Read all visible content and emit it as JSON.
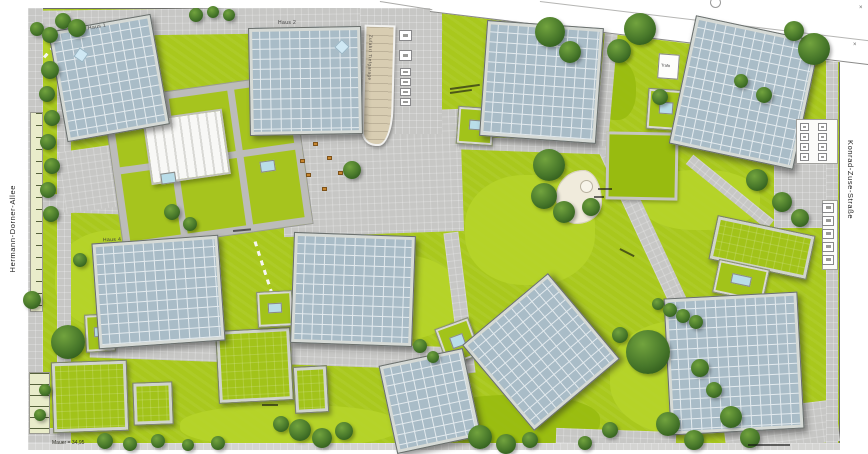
{
  "streets": {
    "left_label": "Hermann-Dorner-Allee",
    "right_label": "Konrad-Zuse-Straße"
  },
  "labels": {
    "haus1": "Haus 1",
    "haus2": "Haus 2",
    "haus4": "Haus 4",
    "ramp": "Zufahrt Tiefgarage",
    "trafo": "Trafo",
    "elevation_note": "Mauer = 34,95",
    "surveyor_mark": "×"
  },
  "colors": {
    "lawn": "#a9c81d",
    "lawn_light": "#b6d42a",
    "lawn_dark": "#98bb10",
    "pavement": "#c7c7c5",
    "pavement_light": "#d4d4d2",
    "solar_roof": "#a9bcc7",
    "solar_grid": "#e3eaee",
    "roof_frame": "#d6dad6",
    "pool": "#b9dde9",
    "ramp": "#d8cdb2",
    "bench": "#c8862f"
  },
  "plan": {
    "paths": [
      {
        "x": 28,
        "y": 8,
        "w": 414,
        "h": 26,
        "rot": -0.8
      },
      {
        "x": 440,
        "y": 15,
        "w": 402,
        "h": 13,
        "rot": 6.9
      },
      {
        "x": 28,
        "y": 8,
        "w": 15,
        "h": 438,
        "rot": 0
      },
      {
        "x": 57,
        "y": 12,
        "w": 14,
        "h": 434,
        "rot": 0
      },
      {
        "x": 282,
        "y": 112,
        "w": 180,
        "h": 122,
        "rot": -2
      },
      {
        "x": 360,
        "y": 8,
        "w": 82,
        "h": 126,
        "rot": 0
      },
      {
        "x": 668,
        "y": 132,
        "w": 18,
        "h": 334,
        "rot": -25
      },
      {
        "x": 90,
        "y": 341,
        "w": 372,
        "h": 23,
        "rot": 2
      },
      {
        "x": 774,
        "y": 150,
        "w": 64,
        "h": 78,
        "rot": 0
      },
      {
        "x": 724,
        "y": 406,
        "w": 114,
        "h": 42,
        "rot": -7
      },
      {
        "x": 28,
        "y": 195,
        "w": 104,
        "h": 18,
        "rot": 2
      },
      {
        "x": 458,
        "y": 139,
        "w": 152,
        "h": 13,
        "rot": 2
      },
      {
        "x": 678,
        "y": 186,
        "w": 104,
        "h": 12,
        "rot": 39
      },
      {
        "x": 600,
        "y": 28,
        "w": 13,
        "h": 118,
        "rot": 5
      },
      {
        "x": 62,
        "y": 148,
        "w": 58,
        "h": 62,
        "rot": -8
      },
      {
        "x": 28,
        "y": 428,
        "w": 32,
        "h": 19,
        "rot": 0
      },
      {
        "x": 452,
        "y": 232,
        "w": 15,
        "h": 142,
        "rot": -7
      },
      {
        "x": 826,
        "y": 56,
        "w": 12,
        "h": 390,
        "rot": 0
      },
      {
        "x": 556,
        "y": 430,
        "w": 120,
        "h": 16,
        "rot": 2
      },
      {
        "x": 28,
        "y": 443,
        "w": 812,
        "h": 7,
        "rot": 0,
        "c": "pavement_light"
      }
    ],
    "lawn_patches": [
      {
        "x": 55,
        "y": 230,
        "w": 130,
        "h": 100
      },
      {
        "x": 465,
        "y": 175,
        "w": 130,
        "h": 110
      },
      {
        "x": 610,
        "y": 320,
        "w": 160,
        "h": 115
      },
      {
        "x": 180,
        "y": 405,
        "w": 220,
        "h": 42
      },
      {
        "x": 330,
        "y": 255,
        "w": 130,
        "h": 85
      },
      {
        "x": 30,
        "y": 24,
        "w": 46,
        "h": 42
      },
      {
        "x": 640,
        "y": 170,
        "w": 120,
        "h": 60
      },
      {
        "x": 430,
        "y": 395,
        "w": 170,
        "h": 52,
        "d": 1
      },
      {
        "x": 596,
        "y": 60,
        "w": 40,
        "h": 60,
        "d": 1
      },
      {
        "x": 240,
        "y": 140,
        "w": 70,
        "h": 22,
        "d": 1
      }
    ],
    "lawn_squares": [
      {
        "x": 606,
        "y": 132,
        "w": 72,
        "h": 68,
        "rot": 1
      }
    ],
    "green_roofs": [
      {
        "x": 52,
        "y": 361,
        "w": 76,
        "h": 71,
        "rot": -2
      },
      {
        "x": 133,
        "y": 382,
        "w": 40,
        "h": 43,
        "rot": -2
      },
      {
        "x": 217,
        "y": 329,
        "w": 75,
        "h": 73,
        "rot": -3
      },
      {
        "x": 294,
        "y": 366,
        "w": 34,
        "h": 47,
        "rot": -3
      },
      {
        "x": 712,
        "y": 225,
        "w": 100,
        "h": 45,
        "rot": 12
      }
    ],
    "pool_courts": [
      {
        "x": 85,
        "y": 314,
        "w": 30,
        "h": 38,
        "rot": -3
      },
      {
        "x": 257,
        "y": 291,
        "w": 36,
        "h": 36,
        "rot": -3
      },
      {
        "x": 457,
        "y": 107,
        "w": 37,
        "h": 38,
        "rot": 4
      },
      {
        "x": 647,
        "y": 89,
        "w": 37,
        "h": 41,
        "rot": 4
      },
      {
        "x": 715,
        "y": 264,
        "w": 52,
        "h": 34,
        "rot": 12
      },
      {
        "x": 440,
        "y": 322,
        "w": 36,
        "h": 40,
        "rot": -20
      }
    ],
    "buildings": [
      {
        "name": "building-haus-1",
        "x": 57,
        "y": 22,
        "w": 104,
        "h": 112,
        "rot": -10,
        "sky": [
          0.22,
          0.2
        ]
      },
      {
        "name": "building-haus-2",
        "x": 249,
        "y": 27,
        "w": 113,
        "h": 108,
        "rot": -1,
        "sky": [
          0.78,
          0.13
        ]
      },
      {
        "name": "building-north-east-1",
        "x": 483,
        "y": 24,
        "w": 117,
        "h": 116,
        "rot": 4
      },
      {
        "name": "building-north-east-2",
        "x": 681,
        "y": 27,
        "w": 127,
        "h": 131,
        "rot": 12
      },
      {
        "name": "building-haus-4",
        "x": 95,
        "y": 239,
        "w": 127,
        "h": 106,
        "rot": -4
      },
      {
        "name": "building-mid-center",
        "x": 292,
        "y": 234,
        "w": 122,
        "h": 111,
        "rot": 2
      },
      {
        "name": "building-diamond",
        "x": 485,
        "y": 296,
        "w": 112,
        "h": 112,
        "rot": -40
      },
      {
        "name": "building-south-east",
        "x": 667,
        "y": 295,
        "w": 134,
        "h": 137,
        "rot": -3
      },
      {
        "name": "building-south-center",
        "x": 387,
        "y": 356,
        "w": 86,
        "h": 90,
        "rot": -12
      }
    ],
    "trees": [
      [
        50,
        70,
        9
      ],
      [
        47,
        94,
        8
      ],
      [
        52,
        118,
        8
      ],
      [
        48,
        142,
        8
      ],
      [
        52,
        166,
        8
      ],
      [
        48,
        190,
        8
      ],
      [
        51,
        214,
        8
      ],
      [
        37,
        29,
        7
      ],
      [
        50,
        35,
        8
      ],
      [
        63,
        21,
        8
      ],
      [
        77,
        28,
        9
      ],
      [
        196,
        15,
        7
      ],
      [
        213,
        12,
        6
      ],
      [
        229,
        15,
        6
      ],
      [
        550,
        32,
        15
      ],
      [
        570,
        52,
        11
      ],
      [
        640,
        29,
        16
      ],
      [
        619,
        51,
        12
      ],
      [
        814,
        49,
        16
      ],
      [
        794,
        31,
        10
      ],
      [
        660,
        97,
        8
      ],
      [
        741,
        81,
        7
      ],
      [
        764,
        95,
        8
      ],
      [
        549,
        165,
        16
      ],
      [
        544,
        196,
        13
      ],
      [
        564,
        212,
        11
      ],
      [
        591,
        207,
        9
      ],
      [
        757,
        180,
        11
      ],
      [
        782,
        202,
        10
      ],
      [
        800,
        218,
        9
      ],
      [
        648,
        352,
        22
      ],
      [
        658,
        304,
        6
      ],
      [
        670,
        310,
        7
      ],
      [
        683,
        316,
        7
      ],
      [
        696,
        322,
        7
      ],
      [
        620,
        335,
        8
      ],
      [
        68,
        342,
        17
      ],
      [
        32,
        300,
        9
      ],
      [
        80,
        260,
        7
      ],
      [
        172,
        212,
        8
      ],
      [
        190,
        224,
        7
      ],
      [
        352,
        170,
        9
      ],
      [
        281,
        424,
        8
      ],
      [
        300,
        430,
        11
      ],
      [
        322,
        438,
        10
      ],
      [
        344,
        431,
        9
      ],
      [
        105,
        441,
        8
      ],
      [
        130,
        444,
        7
      ],
      [
        158,
        441,
        7
      ],
      [
        188,
        445,
        6
      ],
      [
        218,
        443,
        7
      ],
      [
        480,
        437,
        12
      ],
      [
        506,
        444,
        10
      ],
      [
        530,
        440,
        8
      ],
      [
        668,
        424,
        12
      ],
      [
        694,
        440,
        10
      ],
      [
        700,
        368,
        9
      ],
      [
        714,
        390,
        8
      ],
      [
        731,
        417,
        11
      ],
      [
        750,
        438,
        10
      ],
      [
        420,
        346,
        7
      ],
      [
        433,
        357,
        6
      ],
      [
        610,
        430,
        8
      ],
      [
        585,
        443,
        7
      ],
      [
        45,
        390,
        6
      ],
      [
        40,
        415,
        6
      ]
    ],
    "benches": [
      [
        313,
        142
      ],
      [
        327,
        156
      ],
      [
        300,
        159
      ],
      [
        306,
        173
      ],
      [
        322,
        187
      ],
      [
        338,
        171
      ]
    ],
    "slabs": [
      {
        "x": 796,
        "y": 119,
        "w": 42,
        "h": 45
      },
      {
        "x": 822,
        "y": 200,
        "w": 16,
        "h": 70
      }
    ],
    "sign_columns": [
      {
        "x": 399,
        "y": 30,
        "n": 2,
        "w": 13,
        "h": 11,
        "gap": 20
      },
      {
        "x": 400,
        "y": 68,
        "n": 4,
        "w": 11,
        "h": 8,
        "gap": 10
      },
      {
        "x": 822,
        "y": 203,
        "n": 5,
        "w": 12,
        "h": 10,
        "gap": 13
      },
      {
        "x": 800,
        "y": 123,
        "n": 4,
        "w": 9,
        "h": 8,
        "gap": 10
      },
      {
        "x": 818,
        "y": 123,
        "n": 4,
        "w": 9,
        "h": 8,
        "gap": 10
      }
    ],
    "micro_annotations": [
      {
        "x": 450,
        "y": 88,
        "w": 30,
        "rot": -8
      },
      {
        "x": 450,
        "y": 92,
        "w": 22,
        "rot": -8
      },
      {
        "x": 598,
        "y": 188,
        "w": 14,
        "rot": 0
      },
      {
        "x": 594,
        "y": 196,
        "w": 10,
        "rot": 0
      },
      {
        "x": 748,
        "y": 444,
        "w": 42,
        "rot": 0
      },
      {
        "x": 620,
        "y": 248,
        "w": 16,
        "rot": 27
      },
      {
        "x": 233,
        "y": 230,
        "w": 18,
        "rot": -5
      },
      {
        "x": 262,
        "y": 404,
        "w": 16,
        "rot": 0
      }
    ]
  }
}
